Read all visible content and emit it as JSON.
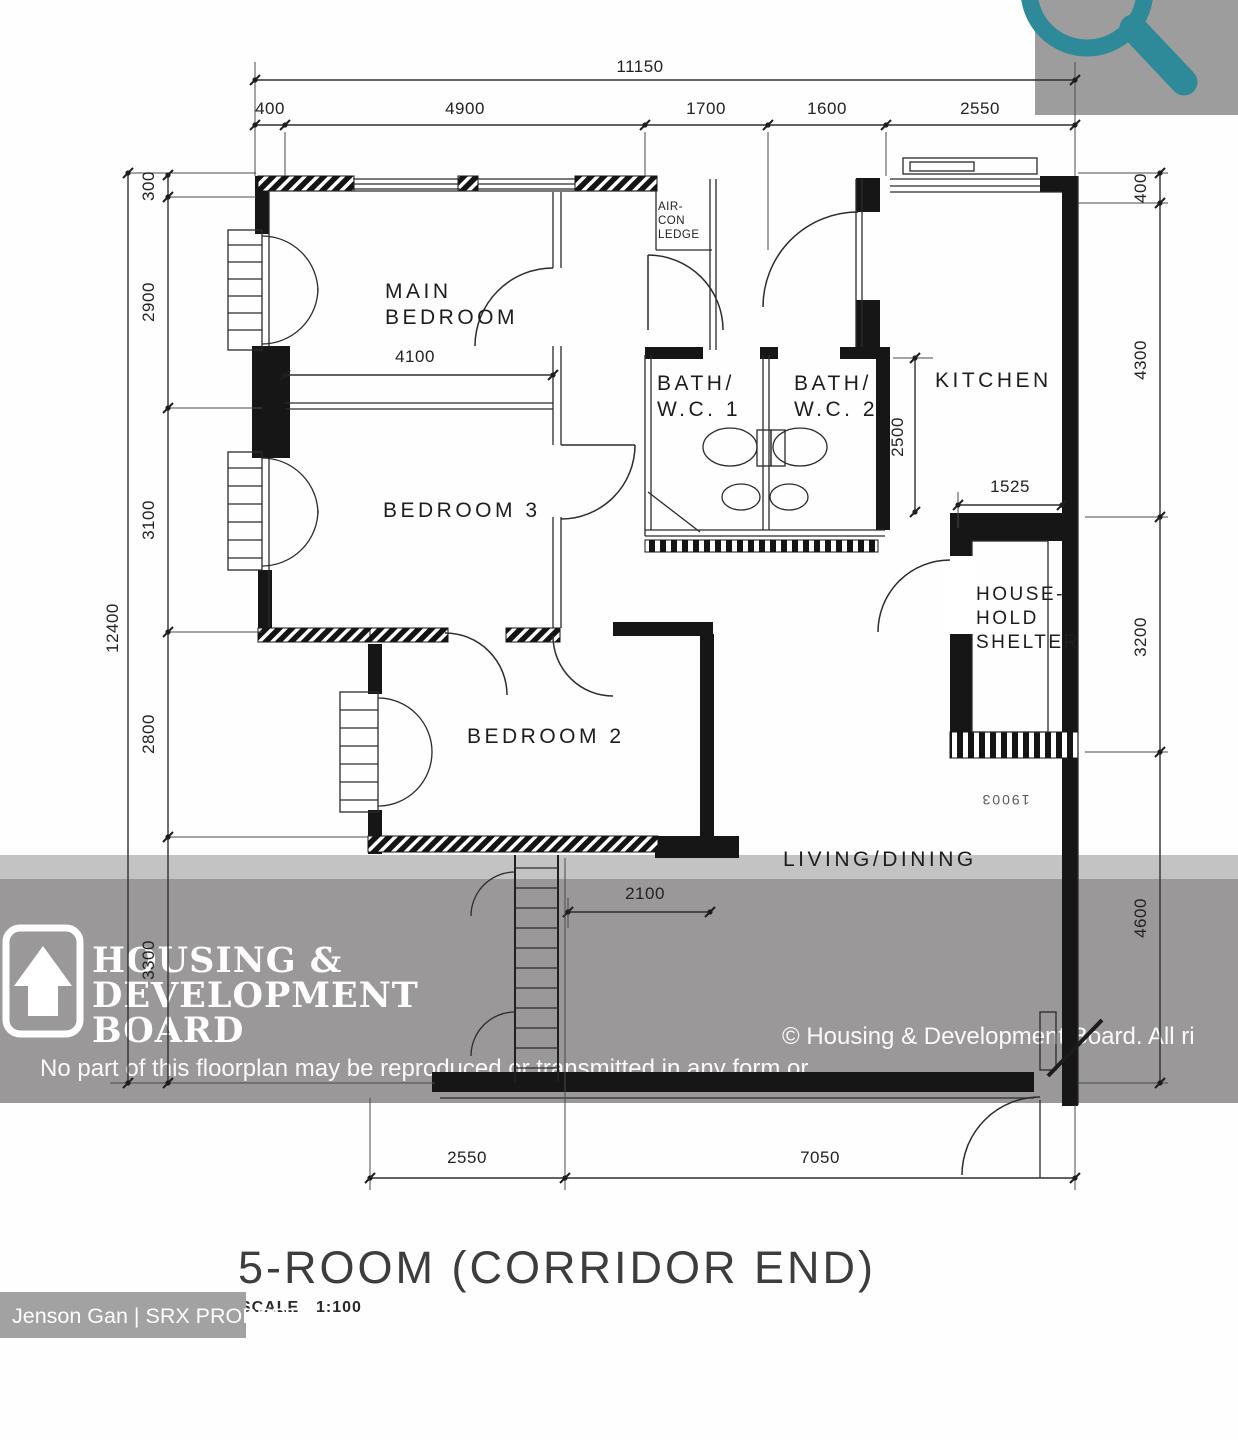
{
  "plan": {
    "title": "5-ROOM (CORRIDOR END)",
    "scale_label": "SCALE",
    "scale_value": "1:100",
    "stamp": "19003",
    "rooms": {
      "main_bedroom": [
        "MAIN",
        "BEDROOM"
      ],
      "bedroom3": "BEDROOM 3",
      "bedroom2": "BEDROOM 2",
      "bath1": [
        "BATH/",
        "W.C. 1"
      ],
      "bath2": [
        "BATH/",
        "W.C. 2"
      ],
      "kitchen": "KITCHEN",
      "household_shelter": [
        "HOUSE-",
        "HOLD",
        "SHELTER"
      ],
      "living_dining": "LIVING/DINING",
      "aircon_ledge": [
        "AIR-",
        "CON",
        "LEDGE"
      ]
    },
    "dimensions": {
      "top_total": "11150",
      "top_segments": [
        "400",
        "4900",
        "1700",
        "1600",
        "2550"
      ],
      "left_total": "12400",
      "left_segments": [
        "300",
        "2900",
        "3100",
        "2800",
        "3300"
      ],
      "right_segments": [
        "400",
        "4300",
        "3200",
        "4600"
      ],
      "bottom_segments": [
        "2550",
        "7050"
      ],
      "main_bedroom_width": "4100",
      "kitchen_depth": "2500",
      "kitchen_width": "1525",
      "living_width": "2100"
    }
  },
  "watermark": {
    "logo_lines": [
      "HOUSING &",
      "DEVELOPMENT",
      "BOARD"
    ],
    "copyright_line1": "© Housing & Development Board. All ri",
    "copyright_line2": "No part of this floorplan may be reproduced or transmitted in any form or"
  },
  "attribution": "Jenson Gan | SRX PROPERTY",
  "colors": {
    "magnifier_teal": "#2e8a98",
    "watermark_gray": "#9a9898",
    "icon_square_gray": "#9e9d9d"
  }
}
